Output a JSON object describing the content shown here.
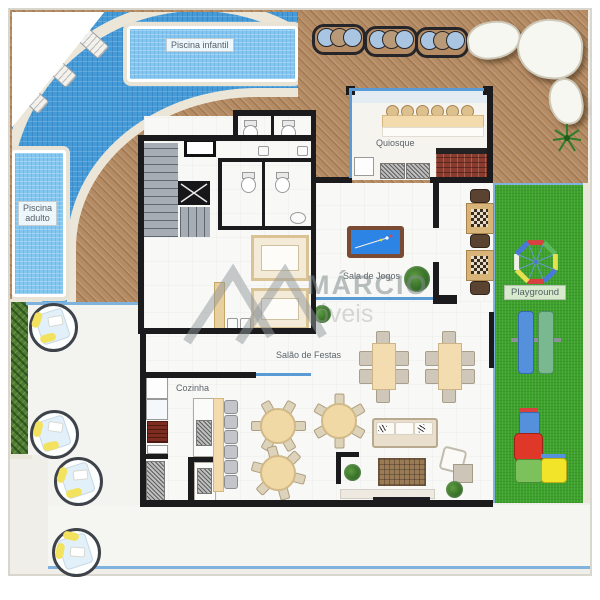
{
  "labels": {
    "piscina_infantil": "Piscina infantil",
    "piscina_adulto_l1": "Piscina",
    "piscina_adulto_l2": "adulto",
    "quiosque": "Quiosque",
    "sala_de_jogos": "Sala de Jogos",
    "playground": "Playground",
    "salao_de_festas": "Salão de Festas",
    "cozinha": "Cozinha"
  },
  "watermark": {
    "name": "MÁRCIO",
    "suffix": "óveis"
  },
  "colors": {
    "deck": "#b58b63",
    "pool_tile": "#459bd8",
    "pool_water": "#83c6f0",
    "grass": "#3da22b",
    "wall": "#1b1b1d",
    "window_blue": "#5b9bd5",
    "fence_blue": "#7fb2dc",
    "floor": "#f8f8f6",
    "label_text": "#566066"
  }
}
